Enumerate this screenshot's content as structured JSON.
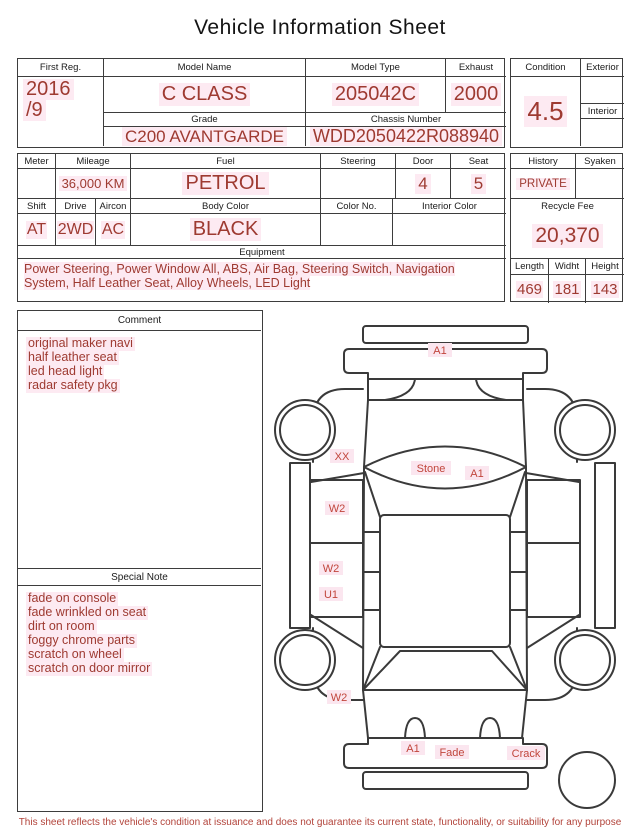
{
  "title": "Vehicle Information Sheet",
  "colors": {
    "accent_red": "#9e3a31",
    "highlight_pink": "#fdeaf2",
    "border": "#3d3d3d",
    "diagram_label_red": "#c1463c"
  },
  "main_table": {
    "first_reg_label": "First Reg.",
    "first_reg_line1": "2016",
    "first_reg_line2": "/9",
    "model_name_label": "Model Name",
    "model_name_value": "C CLASS",
    "model_type_label": "Model Type",
    "model_type_value": "205042C",
    "exhaust_label": "Exhaust",
    "exhaust_value": "2000",
    "grade_label": "Grade",
    "grade_value": "C200 AVANTGARDE",
    "chassis_label": "Chassis Number",
    "chassis_value": "WDD2050422R088940"
  },
  "condition_block": {
    "condition_label": "Condition",
    "condition_value": "4.5",
    "exterior_label": "Exterior",
    "exterior_value": "",
    "interior_label": "Interior",
    "interior_value": ""
  },
  "spec_row1": {
    "meter_label": "Meter",
    "meter_value": "",
    "mileage_label": "Mileage",
    "mileage_value": "36,000 KM",
    "fuel_label": "Fuel",
    "fuel_value": "PETROL",
    "steering_label": "Steering",
    "steering_value": "",
    "door_label": "Door",
    "door_value": "4",
    "seat_label": "Seat",
    "seat_value": "5"
  },
  "history_block": {
    "history_label": "History",
    "history_value": "PRIVATE",
    "syaken_label": "Syaken",
    "syaken_value": ""
  },
  "spec_row2": {
    "shift_label": "Shift",
    "shift_value": "AT",
    "drive_label": "Drive",
    "drive_value": "2WD",
    "aircon_label": "Aircon",
    "aircon_value": "AC",
    "body_color_label": "Body Color",
    "body_color_value": "BLACK",
    "color_no_label": "Color No.",
    "color_no_value": "",
    "interior_color_label": "Interior Color",
    "interior_color_value": ""
  },
  "recycle_block": {
    "label": "Recycle Fee",
    "value": "20,370"
  },
  "equipment": {
    "label": "Equipment",
    "text": "Power Steering, Power Window  All, ABS, Air Bag, Steering Switch, Navigation System, Half Leather Seat, Alloy Wheels, LED Light"
  },
  "dimensions": {
    "length_label": "Length",
    "length_value": "469",
    "width_label": "Widht",
    "width_value": "181",
    "height_label": "Height",
    "height_value": "143"
  },
  "comment": {
    "label": "Comment",
    "lines": [
      "original maker navi",
      "half leather seat",
      "led head light",
      "radar safety pkg"
    ]
  },
  "special_note": {
    "label": "Special Note",
    "lines": [
      "fade on console",
      "fade wrinkled on seat",
      "dirt on room",
      "foggy chrome parts",
      "scratch on wheel",
      "scratch on door mirror"
    ]
  },
  "diagram": {
    "labels": [
      {
        "text": "A1"
      },
      {
        "text": "XX"
      },
      {
        "text": "Stone"
      },
      {
        "text": "A1"
      },
      {
        "text": "W2"
      },
      {
        "text": "W2"
      },
      {
        "text": "U1"
      },
      {
        "text": "W2"
      },
      {
        "text": "A1"
      },
      {
        "text": "Fade"
      },
      {
        "text": "Crack"
      }
    ]
  },
  "footer": "This sheet reflects the vehicle's condition at issuance and does not guarantee its current state, functionality, or suitability for any purpose"
}
